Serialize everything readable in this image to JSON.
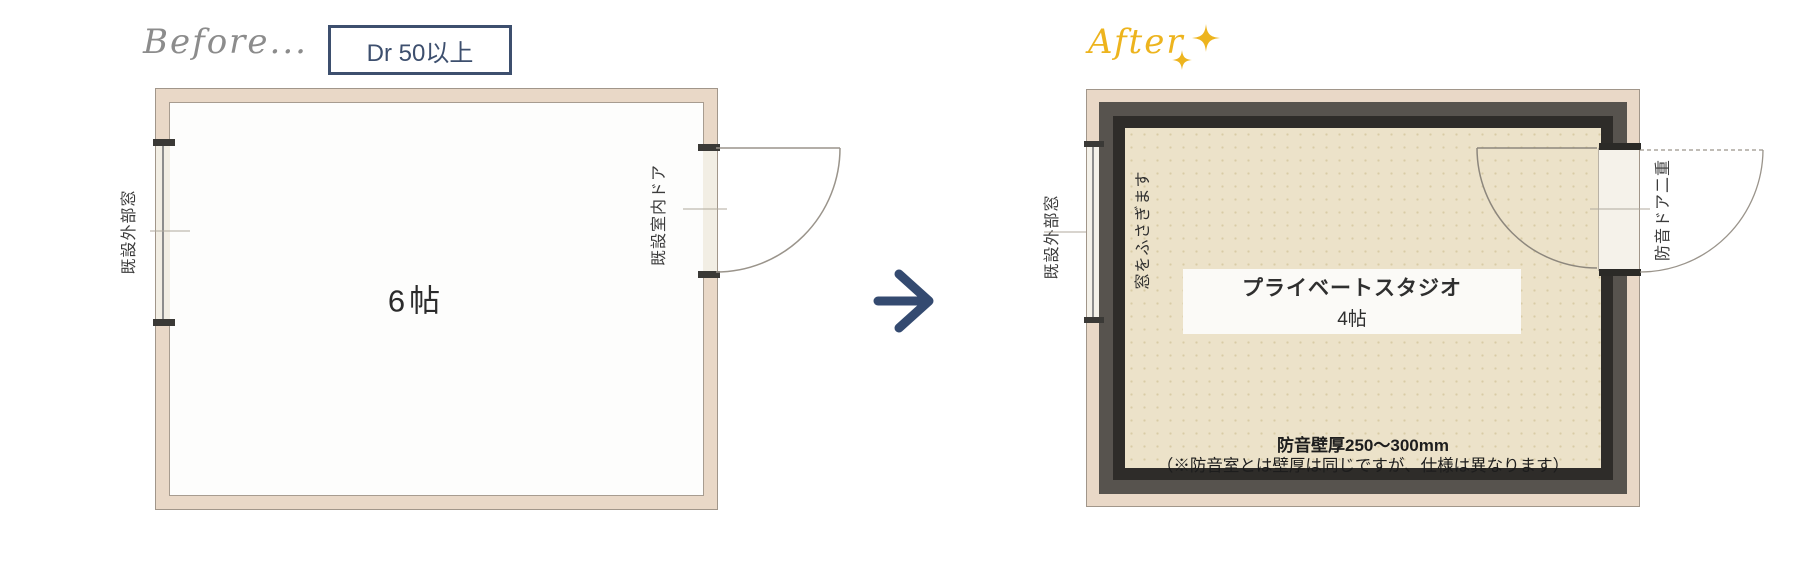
{
  "before": {
    "label": "Before...",
    "badge": "Dr 50以上",
    "room_size": "6帖",
    "window_label": "既設外部窓",
    "door_label": "既設室内ドア"
  },
  "after": {
    "label": "After",
    "room_name": "プライベートスタジオ",
    "room_size": "4帖",
    "window_label": "既設外部窓",
    "window_note": "窓をふさぎます",
    "door_label": "防音ドア二重",
    "wall_note_title": "防音壁厚250〜300mm",
    "wall_note_detail": "（※防音室とは壁厚は同じですが、仕様は異なります）"
  },
  "icons": {
    "arrow": "right-arrow",
    "sparkle": "four-point-star"
  },
  "colors": {
    "accent_navy": "#3d4f6e",
    "accent_gold": "#edb41e",
    "wall_beige": "#e9d8c7",
    "soundproof_gray": "#57534e",
    "soundproof_dark": "#2e2c29",
    "interior_cream": "#ece2c9",
    "label_gray": "#8c8c8c"
  }
}
